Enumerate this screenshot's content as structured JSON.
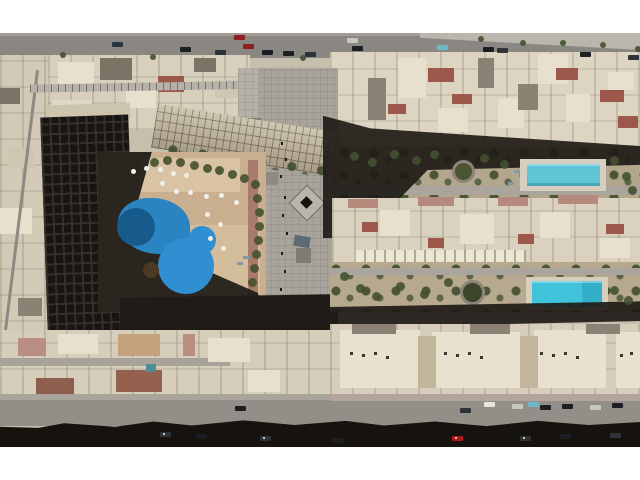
{
  "scene": {
    "type": "aerial-drone-photo",
    "description": "Top-down aerial drone photograph of a desert resort residential compound: a U-shaped apartment block with a free-form blue swimming pool and white parasols in a shaded courtyard on the left, a long grey tiled pedestrian plaza running down the centre, rows of beige villas with red roofs on the right with two rectangular turquoise pools in garden strips, a road with cars at top and a shadowed street with parked cars at bottom, letterboxed with white bars",
    "palette": {
      "letterbox": "#ffffff",
      "ground": "#c7bfae",
      "sidewalk": "#a19d95",
      "road": "#8a8783",
      "road_light": "#bab6ae",
      "street": "#938f88",
      "sidewalk_pink": "#b2a39b",
      "sidewalk_left": "#aaa59b",
      "lane": "#a7a39a",
      "houses_left": "#d8d0bc",
      "houses_rowA": "#ddd5c1",
      "houses_rowB": "#dad2bf",
      "houses_rowC": "#d6ceba",
      "left_column": "#d2cab7",
      "plaza": "#a8a49c",
      "plaza_light": "#b5b1a8",
      "plaza_dark": "#807b72",
      "pergola": "#b6b2a9",
      "wing_base": "#c9bfa8",
      "tower": "#171411",
      "tower_roof": "#cdc4ae",
      "deck": "#c9ae90",
      "deck_light": "#d9c3a2",
      "deck_light2": "#d4bd9a",
      "terracotta": "#a87b6a",
      "shadow": "#1f1b17",
      "shadow_deep": "#16130f",
      "pool_main": "#2b84c2",
      "pool_dark": "#175a8c",
      "pool_lobe": "#2f8fd0",
      "pool_rect1": "#5fc4d6",
      "pool_rect2": "#3fc2da",
      "pool_pad": "#d6cfbf",
      "garden1": "#b2a68c",
      "garden2": "#b6a98f",
      "green": "#42512f",
      "path": "#a9a59c",
      "island": "#4a3a22",
      "white_roof": "#e7e0ce",
      "building_light": "#e0d8c5",
      "beige2": "#cfc6b1",
      "cream": "#e8e1cf",
      "court_tan": "#c1b59b",
      "scallop": "#ece6d5",
      "roof_red": "#9c584a",
      "roof_grey": "#8b8174",
      "roof_darkgrey": "#7b7365",
      "roof_pink": "#b5897b",
      "roof_pink2": "#b98f82",
      "roof_ochre": "#c3a37e",
      "roof_brown": "#8e5f4e",
      "roof_brown2": "#96604e",
      "teal": "#4e8d96",
      "salmon": "#c08873",
      "solar": "#5d6a74",
      "kiosk": "#bab5ab",
      "kiosk2": "#8e8a82",
      "ring_grey": "#8b8478",
      "scaffold": "#8d8a84",
      "umbrella": "#f2efe8",
      "lounger": "#7f9aa8",
      "person": "#1d1a16",
      "headlight": "#f5f2ea",
      "ac_unit": "#3a362f",
      "car_dark": "#1b1e22",
      "car_dark2": "#2e3338",
      "car_red": "#8e2024",
      "car_red_bright": "#b01818",
      "car_white": "#e8e6e0",
      "car_silver": "#c9c7c1",
      "car_cyan": "#6fb7c9",
      "car_blue": "#2a3340"
    },
    "elements": [
      "top road with moving and parked cars",
      "row of beige houses below top road",
      "long pergola walkway",
      "U-shaped apartment complex with balconied wing and dark tower in shadow",
      "free-form blue swimming pool with island, white parasols, tan sun deck",
      "central grey tiled pedestrian plaza with kiosks and pedestrians",
      "villa rows with red and pink roofs",
      "two rectangular turquoise pools in garden strips",
      "circular landscaped tree features",
      "bottom street with parked cars and long building shadow",
      "white letterbox bars top and bottom"
    ]
  },
  "sprites": [
    {
      "layer": "photo-area",
      "cls": "car",
      "name": "car-top-road",
      "items": [
        [
          234,
          35,
          "car_red"
        ],
        [
          243,
          44,
          "car_red"
        ],
        [
          112,
          42,
          "car_blue"
        ],
        [
          180,
          47,
          "car_dark"
        ],
        [
          215,
          50,
          "car_dark2"
        ],
        [
          262,
          50,
          "car_dark"
        ],
        [
          283,
          51,
          "car_dark"
        ],
        [
          305,
          52,
          "car_dark2"
        ],
        [
          347,
          38,
          "car_silver"
        ],
        [
          352,
          46,
          "car_dark"
        ],
        [
          437,
          45,
          "car_cyan"
        ],
        [
          483,
          47,
          "car_dark"
        ],
        [
          497,
          48,
          "car_dark2"
        ],
        [
          580,
          52,
          "car_dark"
        ],
        [
          628,
          55,
          "car_dark2"
        ]
      ]
    },
    {
      "layer": "photo-area",
      "cls": "car",
      "name": "car-bottom-street",
      "items": [
        [
          484,
          402,
          "car_white"
        ],
        [
          512,
          404,
          "car_silver"
        ],
        [
          528,
          402,
          "car_cyan"
        ],
        [
          540,
          405,
          "car_dark"
        ],
        [
          562,
          404,
          "car_dark"
        ],
        [
          590,
          405,
          "car_silver"
        ],
        [
          612,
          403,
          "car_dark"
        ],
        [
          460,
          408,
          "car_dark2"
        ],
        [
          235,
          406,
          "car_dark"
        ]
      ]
    },
    {
      "layer": "photo-area",
      "cls": "car",
      "name": "car-in-shadow",
      "items": [
        [
          160,
          432,
          "car_dark2"
        ],
        [
          196,
          434,
          "car_dark"
        ],
        [
          260,
          436,
          "car_dark2"
        ],
        [
          332,
          438,
          "car_dark"
        ],
        [
          452,
          436,
          "car_red_bright"
        ],
        [
          520,
          436,
          "car_dark2"
        ],
        [
          560,
          434,
          "car_dark"
        ],
        [
          610,
          433,
          "car_dark2"
        ]
      ]
    },
    {
      "layer": "photo-area",
      "cls": "spark",
      "name": "headlight-glint",
      "items": [
        [
          163,
          433,
          "headlight"
        ],
        [
          263,
          437,
          "headlight"
        ],
        [
          523,
          437,
          "headlight"
        ],
        [
          455,
          437,
          "headlight"
        ]
      ]
    },
    {
      "layer": "photo-area",
      "cls": "dot",
      "name": "pool-parasol",
      "items": [
        [
          131,
          169,
          "umbrella"
        ],
        [
          144,
          166,
          "umbrella"
        ],
        [
          158,
          167,
          "umbrella"
        ],
        [
          171,
          171,
          "umbrella"
        ],
        [
          184,
          173,
          "umbrella"
        ],
        [
          160,
          181,
          "umbrella"
        ],
        [
          174,
          189,
          "umbrella"
        ],
        [
          188,
          190,
          "umbrella"
        ],
        [
          204,
          194,
          "umbrella"
        ],
        [
          219,
          193,
          "umbrella"
        ],
        [
          234,
          200,
          "umbrella"
        ],
        [
          205,
          212,
          "umbrella"
        ],
        [
          218,
          222,
          "umbrella"
        ],
        [
          208,
          236,
          "umbrella"
        ],
        [
          221,
          246,
          "umbrella"
        ]
      ]
    },
    {
      "layer": "photo-area",
      "cls": "lounger",
      "name": "sun-lounger",
      "items": [
        [
          243,
          256,
          "lounger"
        ],
        [
          237,
          262,
          "lounger"
        ],
        [
          514,
          170,
          "lounger"
        ],
        [
          508,
          182,
          "lounger"
        ]
      ]
    },
    {
      "layer": "photo-area",
      "cls": "tree",
      "name": "courtyard-tree",
      "items": [
        [
          150,
          158
        ],
        [
          163,
          156
        ],
        [
          176,
          158
        ],
        [
          190,
          161
        ],
        [
          203,
          164
        ],
        [
          215,
          166
        ],
        [
          228,
          170
        ],
        [
          240,
          174
        ],
        [
          251,
          180
        ],
        [
          253,
          194
        ],
        [
          255,
          208
        ],
        [
          255,
          222
        ],
        [
          254,
          236
        ],
        [
          252,
          250
        ],
        [
          250,
          264
        ],
        [
          248,
          278
        ]
      ]
    },
    {
      "layer": "photo-area",
      "cls": "tree",
      "name": "garden-tree",
      "items": [
        [
          350,
          152
        ],
        [
          368,
          158
        ],
        [
          390,
          150
        ],
        [
          412,
          156
        ],
        [
          430,
          150
        ],
        [
          480,
          154
        ],
        [
          500,
          160
        ],
        [
          610,
          156
        ],
        [
          622,
          172
        ],
        [
          628,
          186
        ],
        [
          340,
          272
        ],
        [
          356,
          284
        ],
        [
          372,
          292
        ],
        [
          396,
          282
        ],
        [
          420,
          290
        ],
        [
          444,
          278
        ],
        [
          610,
          286
        ],
        [
          624,
          296
        ]
      ]
    },
    {
      "layer": "photo-area",
      "cls": "tree sm",
      "name": "street-tree",
      "items": [
        [
          60,
          52
        ],
        [
          150,
          54
        ],
        [
          300,
          55
        ],
        [
          520,
          40
        ],
        [
          560,
          40
        ],
        [
          600,
          42
        ],
        [
          478,
          36
        ],
        [
          635,
          46
        ]
      ]
    },
    {
      "layer": "photo-area",
      "cls": "person",
      "name": "pedestrian",
      "items": [
        [
          281,
          142,
          "person"
        ],
        [
          285,
          158,
          "person"
        ],
        [
          280,
          175,
          "person"
        ],
        [
          284,
          196,
          "person"
        ],
        [
          282,
          214,
          "person"
        ],
        [
          286,
          232,
          "person"
        ],
        [
          281,
          252,
          "person"
        ],
        [
          284,
          270,
          "person"
        ],
        [
          280,
          288,
          "person"
        ],
        [
          285,
          306,
          "person"
        ],
        [
          282,
          322,
          "person"
        ]
      ]
    },
    {
      "layer": "photo-area",
      "cls": "ac",
      "name": "rooftop-ac-unit",
      "items": [
        [
          350,
          352,
          "ac_unit"
        ],
        [
          362,
          354,
          "ac_unit"
        ],
        [
          374,
          352,
          "ac_unit"
        ],
        [
          386,
          356,
          "ac_unit"
        ],
        [
          444,
          352,
          "ac_unit"
        ],
        [
          456,
          354,
          "ac_unit"
        ],
        [
          468,
          352,
          "ac_unit"
        ],
        [
          480,
          356,
          "ac_unit"
        ],
        [
          540,
          352,
          "ac_unit"
        ],
        [
          552,
          354,
          "ac_unit"
        ],
        [
          564,
          352,
          "ac_unit"
        ],
        [
          576,
          356,
          "ac_unit"
        ],
        [
          620,
          354,
          "ac_unit"
        ],
        [
          630,
          352,
          "ac_unit"
        ]
      ]
    }
  ]
}
